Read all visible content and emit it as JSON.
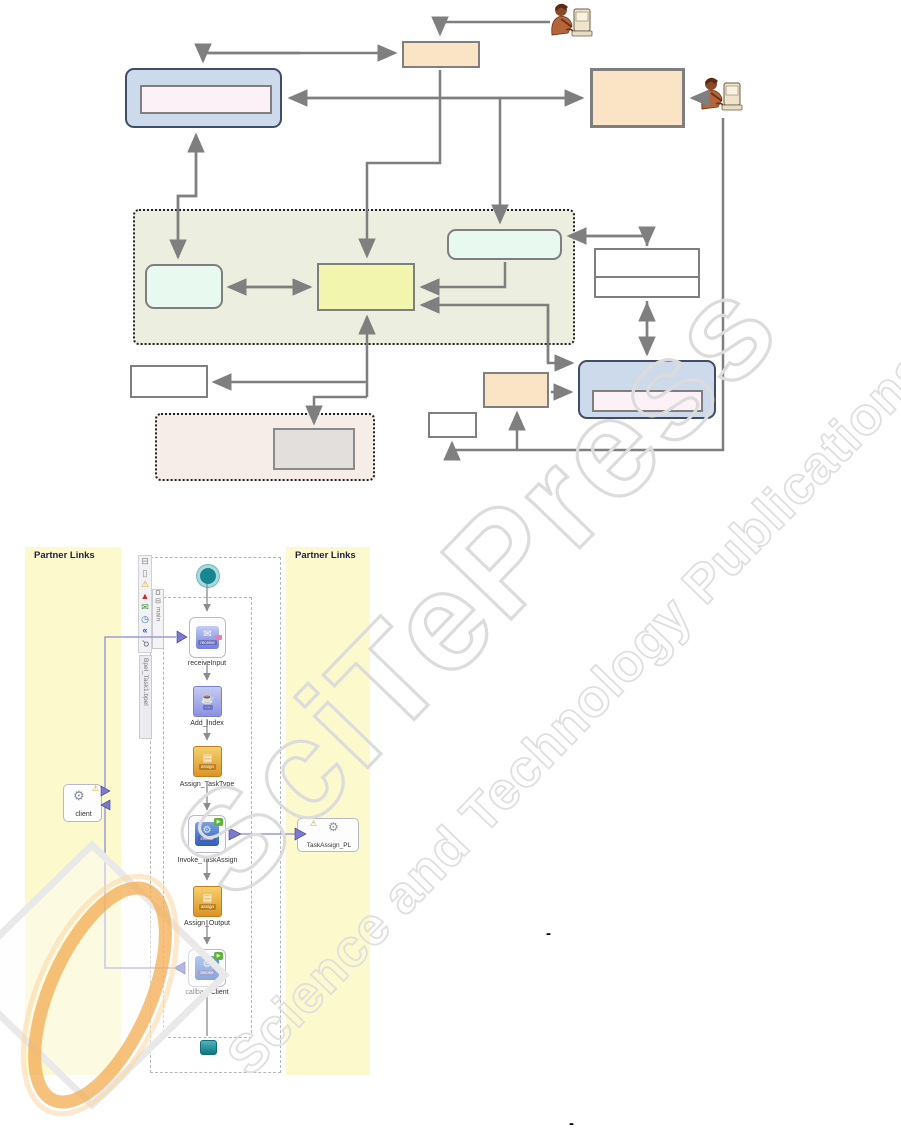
{
  "watermark": {
    "title": "SciTePress",
    "subtitle": "Science and Technology Publications"
  },
  "palette": {
    "box_orange": "#fbe4c6",
    "box_blue": "#ccdaec",
    "box_blue_border": "#3f4e66",
    "box_pink_inner": "#fcf1f7",
    "container_olive": "#eceedf",
    "box_green": "#e8f9ef",
    "box_yellow": "#f1f5ad",
    "container_pink": "#f6ede9",
    "box_gray": "#e2dfdc",
    "arrow_gray": "#7f7f7f",
    "bpel_panel_yellow": "#fcf9cc",
    "bpel_link_purple": "#9b9bd8"
  },
  "bpel": {
    "left_panel_title": "Partner Links",
    "right_panel_title": "Partner Links",
    "scope_tab_label": "main",
    "process_tab_label": "Bpel_Task1.bpel",
    "toolbar_icons": [
      "collapse",
      "document",
      "warning",
      "error",
      "mail",
      "clock",
      "rewind",
      "search"
    ],
    "flow_nodes": [
      {
        "label": "receiveInput",
        "caption": "receive"
      },
      {
        "label": "Add_Index",
        "caption": "····"
      },
      {
        "label": "Assign_TaskType",
        "caption": "assign"
      },
      {
        "label": "Invoke_TaskAssign",
        "caption": "invoke"
      },
      {
        "label": "Assign_Output",
        "caption": "assign"
      },
      {
        "label": "callbackClient",
        "caption": "invoke"
      }
    ],
    "partner_links": {
      "client_label": "client",
      "taskassign_label": "TaskAssign_PL"
    }
  },
  "marks": {
    "dash1": "-",
    "dash2": "-"
  },
  "glyphs": {
    "collapse": "⊟",
    "document": "▯",
    "warning": "⚠",
    "error": "▲",
    "mail": "✉",
    "clock": "◷",
    "rewind": "«",
    "search": "⚲",
    "lock": "Ω",
    "monitor": "⊟",
    "gear": "⚙",
    "warn": "⚠",
    "envelope": "✉",
    "cup": "☕",
    "pages": "▤",
    "play": "▶"
  }
}
